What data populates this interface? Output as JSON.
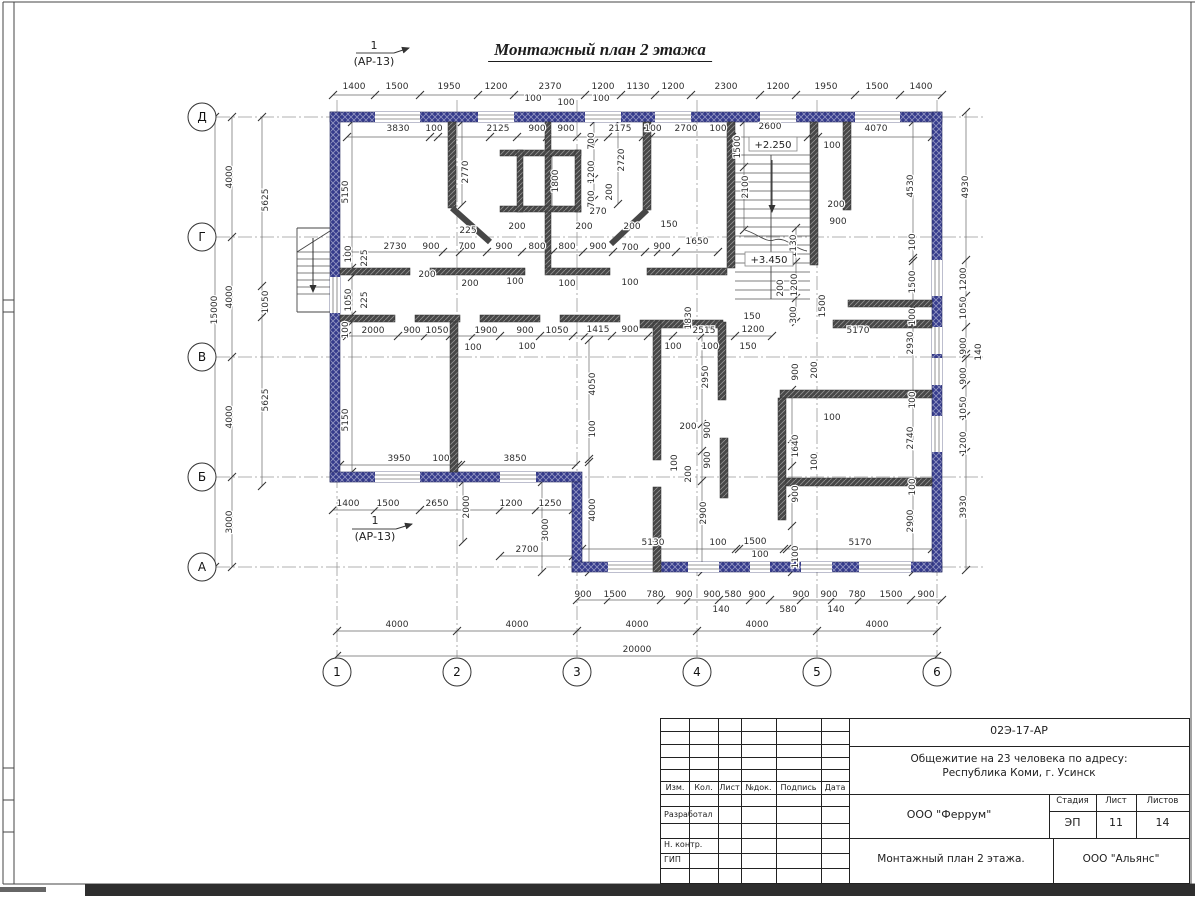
{
  "sheet": {
    "title": "Монтажный план 2 этажа"
  },
  "section_markers": [
    {
      "num": "1",
      "ref": "(АР-13)",
      "x": 374,
      "y": 49
    },
    {
      "num": "1",
      "ref": "(АР-13)",
      "x": 375,
      "y": 524
    }
  ],
  "levels": [
    {
      "t": "+2.250",
      "x": 773,
      "y": 147
    },
    {
      "t": "+3.450",
      "x": 769,
      "y": 262
    }
  ],
  "axes": {
    "rows": [
      [
        "Д",
        117
      ],
      [
        "Г",
        237
      ],
      [
        "В",
        357
      ],
      [
        "Б",
        477
      ],
      [
        "А",
        567
      ]
    ],
    "cols": [
      [
        "1",
        337
      ],
      [
        "2",
        457
      ],
      [
        "3",
        577
      ],
      [
        "4",
        697
      ],
      [
        "5",
        817
      ],
      [
        "6",
        937
      ]
    ]
  },
  "dims": [
    [
      354,
      89,
      "1400"
    ],
    [
      397,
      89,
      "1500"
    ],
    [
      449,
      89,
      "1950"
    ],
    [
      496,
      89,
      "1200"
    ],
    [
      550,
      89,
      "2370"
    ],
    [
      603,
      89,
      "1200"
    ],
    [
      638,
      89,
      "1130"
    ],
    [
      673,
      89,
      "1200"
    ],
    [
      726,
      89,
      "2300"
    ],
    [
      778,
      89,
      "1200"
    ],
    [
      826,
      89,
      "1950"
    ],
    [
      877,
      89,
      "1500"
    ],
    [
      921,
      89,
      "1400"
    ],
    [
      533,
      101,
      "100"
    ],
    [
      566,
      105,
      "100"
    ],
    [
      601,
      101,
      "100"
    ],
    [
      398,
      131,
      "3830"
    ],
    [
      434,
      131,
      "100"
    ],
    [
      498,
      131,
      "2125"
    ],
    [
      537,
      131,
      "900"
    ],
    [
      566,
      131,
      "900"
    ],
    [
      620,
      131,
      "2175"
    ],
    [
      653,
      131,
      "100"
    ],
    [
      686,
      131,
      "2700"
    ],
    [
      718,
      131,
      "100"
    ],
    [
      770,
      129,
      "2600"
    ],
    [
      876,
      131,
      "4070"
    ],
    [
      832,
      148,
      "100"
    ],
    [
      348,
      192,
      "5150",
      1
    ],
    [
      468,
      172,
      "2770",
      1
    ],
    [
      558,
      181,
      "1800",
      1
    ],
    [
      594,
      141,
      "700",
      1
    ],
    [
      594,
      172,
      "1200",
      1
    ],
    [
      594,
      199,
      "700",
      1
    ],
    [
      612,
      192,
      "200",
      1
    ],
    [
      624,
      160,
      "2720",
      1
    ],
    [
      740,
      147,
      "1500",
      1
    ],
    [
      748,
      187,
      "2100",
      1
    ],
    [
      913,
      186,
      "4530",
      1
    ],
    [
      968,
      187,
      "4930",
      1
    ],
    [
      796,
      246,
      "1130",
      1
    ],
    [
      797,
      285,
      "1200",
      1
    ],
    [
      783,
      288,
      "200",
      1
    ],
    [
      796,
      315,
      "300",
      1
    ],
    [
      825,
      306,
      "1500",
      1
    ],
    [
      836,
      207,
      "200"
    ],
    [
      838,
      224,
      "900"
    ],
    [
      395,
      249,
      "2730"
    ],
    [
      431,
      249,
      "900"
    ],
    [
      467,
      249,
      "700"
    ],
    [
      504,
      249,
      "900"
    ],
    [
      537,
      249,
      "800"
    ],
    [
      567,
      249,
      "800"
    ],
    [
      598,
      249,
      "900"
    ],
    [
      630,
      250,
      "700"
    ],
    [
      662,
      249,
      "900"
    ],
    [
      697,
      244,
      "1650"
    ],
    [
      669,
      227,
      "150"
    ],
    [
      468,
      233,
      "225"
    ],
    [
      517,
      229,
      "200"
    ],
    [
      584,
      229,
      "200"
    ],
    [
      632,
      229,
      "200"
    ],
    [
      427,
      277,
      "200"
    ],
    [
      470,
      286,
      "200"
    ],
    [
      515,
      284,
      "100"
    ],
    [
      567,
      286,
      "100"
    ],
    [
      630,
      285,
      "100"
    ],
    [
      598,
      214,
      "270"
    ],
    [
      351,
      254,
      "100",
      1
    ],
    [
      367,
      258,
      "225",
      1
    ],
    [
      351,
      300,
      "1050",
      1
    ],
    [
      367,
      300,
      "225",
      1
    ],
    [
      348,
      330,
      "100",
      1
    ],
    [
      373,
      333,
      "2000"
    ],
    [
      412,
      333,
      "900"
    ],
    [
      437,
      333,
      "1050"
    ],
    [
      486,
      333,
      "1900"
    ],
    [
      525,
      333,
      "900"
    ],
    [
      557,
      333,
      "1050"
    ],
    [
      598,
      332,
      "1415"
    ],
    [
      630,
      332,
      "900"
    ],
    [
      704,
      333,
      "2515"
    ],
    [
      753,
      332,
      "1200"
    ],
    [
      473,
      350,
      "100"
    ],
    [
      527,
      349,
      "100"
    ],
    [
      673,
      349,
      "100"
    ],
    [
      710,
      349,
      "100"
    ],
    [
      752,
      319,
      "150"
    ],
    [
      748,
      349,
      "150"
    ],
    [
      691,
      318,
      "1830",
      1
    ],
    [
      858,
      333,
      "5170"
    ],
    [
      913,
      343,
      "2930",
      1
    ],
    [
      595,
      384,
      "4050",
      1
    ],
    [
      595,
      429,
      "100",
      1
    ],
    [
      708,
      377,
      "2950",
      1
    ],
    [
      915,
      242,
      "100",
      1
    ],
    [
      915,
      282,
      "1500",
      1
    ],
    [
      915,
      317,
      "100",
      1
    ],
    [
      915,
      400,
      "100",
      1
    ],
    [
      913,
      438,
      "2740",
      1
    ],
    [
      915,
      487,
      "100",
      1
    ],
    [
      913,
      521,
      "2900",
      1
    ],
    [
      966,
      279,
      "1200",
      1
    ],
    [
      966,
      308,
      "1050",
      1
    ],
    [
      966,
      346,
      "900",
      1
    ],
    [
      981,
      352,
      "140",
      1
    ],
    [
      966,
      376,
      "900",
      1
    ],
    [
      966,
      408,
      "1050",
      1
    ],
    [
      966,
      443,
      "1200",
      1
    ],
    [
      966,
      507,
      "3930",
      1
    ],
    [
      688,
      429,
      "200"
    ],
    [
      710,
      430,
      "900",
      1
    ],
    [
      677,
      463,
      "100",
      1
    ],
    [
      691,
      474,
      "200",
      1
    ],
    [
      710,
      460,
      "900",
      1
    ],
    [
      595,
      510,
      "4000",
      1
    ],
    [
      706,
      513,
      "2900",
      1
    ],
    [
      798,
      446,
      "1640",
      1
    ],
    [
      817,
      462,
      "100",
      1
    ],
    [
      798,
      494,
      "900",
      1
    ],
    [
      798,
      557,
      "1100",
      1
    ],
    [
      798,
      372,
      "900",
      1
    ],
    [
      817,
      370,
      "200",
      1
    ],
    [
      832,
      420,
      "100"
    ],
    [
      399,
      461,
      "3950"
    ],
    [
      441,
      461,
      "100"
    ],
    [
      515,
      461,
      "3850"
    ],
    [
      348,
      420,
      "5150",
      1
    ],
    [
      348,
      506,
      "1400"
    ],
    [
      388,
      506,
      "1500"
    ],
    [
      437,
      506,
      "2650"
    ],
    [
      469,
      507,
      "2000",
      1
    ],
    [
      511,
      506,
      "1200"
    ],
    [
      550,
      506,
      "1250"
    ],
    [
      548,
      530,
      "3000",
      1
    ],
    [
      527,
      552,
      "2700"
    ],
    [
      653,
      545,
      "5130"
    ],
    [
      718,
      545,
      "100"
    ],
    [
      755,
      544,
      "1500"
    ],
    [
      760,
      557,
      "100"
    ],
    [
      860,
      545,
      "5170"
    ],
    [
      583,
      597,
      "900"
    ],
    [
      615,
      597,
      "1500"
    ],
    [
      655,
      597,
      "780"
    ],
    [
      684,
      597,
      "900"
    ],
    [
      712,
      597,
      "900"
    ],
    [
      733,
      597,
      "580"
    ],
    [
      757,
      597,
      "900"
    ],
    [
      801,
      597,
      "900"
    ],
    [
      829,
      597,
      "900"
    ],
    [
      857,
      597,
      "780"
    ],
    [
      891,
      597,
      "1500"
    ],
    [
      926,
      597,
      "900"
    ],
    [
      721,
      612,
      "140"
    ],
    [
      788,
      612,
      "580"
    ],
    [
      836,
      612,
      "140"
    ],
    [
      397,
      627,
      "4000"
    ],
    [
      517,
      627,
      "4000"
    ],
    [
      637,
      627,
      "4000"
    ],
    [
      757,
      627,
      "4000"
    ],
    [
      877,
      627,
      "4000"
    ],
    [
      637,
      652,
      "20000"
    ],
    [
      232,
      177,
      "4000",
      1
    ],
    [
      232,
      297,
      "4000",
      1
    ],
    [
      232,
      417,
      "4000",
      1
    ],
    [
      232,
      522,
      "3000",
      1
    ],
    [
      217,
      310,
      "15000",
      1
    ],
    [
      268,
      200,
      "5625",
      1
    ],
    [
      268,
      302,
      "1050",
      1
    ],
    [
      268,
      400,
      "5625",
      1
    ]
  ],
  "geometry": {
    "walls_ext": [
      [
        330,
        112,
        612,
        10
      ],
      [
        330,
        112,
        10,
        370
      ],
      [
        330,
        472,
        252,
        10
      ],
      [
        572,
        482,
        10,
        90
      ],
      [
        572,
        562,
        370,
        10
      ],
      [
        932,
        112,
        10,
        460
      ]
    ],
    "windows_h": [
      [
        112,
        375,
        420
      ],
      [
        112,
        478,
        514
      ],
      [
        112,
        585,
        621
      ],
      [
        112,
        655,
        691
      ],
      [
        112,
        760,
        796
      ],
      [
        112,
        855,
        900
      ],
      [
        472,
        375,
        420
      ],
      [
        472,
        500,
        536
      ],
      [
        562,
        608,
        661
      ],
      [
        562,
        688,
        719
      ],
      [
        562,
        750,
        770
      ],
      [
        562,
        801,
        832
      ],
      [
        562,
        859,
        911
      ]
    ],
    "windows_v": [
      [
        932,
        260,
        296
      ],
      [
        932,
        327,
        354
      ],
      [
        932,
        358,
        385
      ],
      [
        932,
        416,
        452
      ],
      [
        330,
        277,
        313
      ]
    ],
    "walls_int": [
      [
        448,
        122,
        8,
        86
      ],
      [
        545,
        122,
        6,
        146
      ],
      [
        500,
        150,
        81,
        6
      ],
      [
        500,
        206,
        81,
        6
      ],
      [
        517,
        150,
        6,
        62
      ],
      [
        575,
        150,
        6,
        62
      ],
      [
        643,
        122,
        8,
        88
      ],
      [
        727,
        122,
        8,
        146
      ],
      [
        810,
        122,
        8,
        143
      ],
      [
        843,
        122,
        8,
        88
      ],
      [
        340,
        268,
        70,
        7
      ],
      [
        430,
        268,
        95,
        7
      ],
      [
        545,
        268,
        65,
        7
      ],
      [
        647,
        268,
        80,
        7
      ],
      [
        340,
        315,
        55,
        7
      ],
      [
        415,
        315,
        45,
        7
      ],
      [
        480,
        315,
        60,
        7
      ],
      [
        560,
        315,
        60,
        7
      ],
      [
        640,
        320,
        83,
        8
      ],
      [
        833,
        320,
        99,
        8
      ],
      [
        450,
        322,
        8,
        150
      ],
      [
        848,
        300,
        84,
        7
      ],
      [
        653,
        322,
        8,
        138
      ],
      [
        653,
        487,
        8,
        85
      ],
      [
        718,
        322,
        8,
        78
      ],
      [
        720,
        438,
        8,
        60
      ],
      [
        780,
        390,
        152,
        8
      ],
      [
        780,
        478,
        152,
        8
      ],
      [
        778,
        398,
        8,
        122
      ]
    ],
    "diagonals": [
      [
        452,
        208,
        490,
        242
      ],
      [
        647,
        210,
        611,
        244
      ]
    ],
    "dimlines_h": [
      [
        95,
        [
          333,
          375,
          420,
          478,
          514,
          585,
          621,
          655,
          691,
          760,
          796,
          855,
          900,
          942
        ]
      ],
      [
        137,
        [
          347,
          430,
          438,
          490,
          517,
          547,
          577,
          608,
          643,
          651,
          732,
          808,
          818,
          932
        ]
      ],
      [
        252,
        [
          347,
          443,
          460,
          487,
          522,
          553,
          583,
          613,
          645,
          658,
          676,
          718
        ]
      ],
      [
        336,
        [
          347,
          398,
          425,
          450,
          473,
          500,
          540,
          573,
          585,
          612,
          648,
          673,
          735,
          772
        ]
      ],
      [
        465,
        [
          340,
          458,
          461,
          576
        ]
      ],
      [
        549,
        [
          582,
          736,
          739,
          784,
          787,
          932
        ]
      ],
      [
        600,
        [
          577,
          608,
          661,
          688,
          719,
          750,
          770,
          801,
          832,
          859,
          911,
          942
        ]
      ],
      [
        631,
        [
          337,
          457,
          577,
          697,
          817,
          937
        ]
      ],
      [
        656,
        [
          337,
          937
        ]
      ],
      [
        510,
        [
          333,
          375,
          420,
          500,
          536,
          573
        ]
      ],
      [
        556,
        [
          500,
          573
        ]
      ]
    ],
    "dimlines_v": [
      [
        232,
        [
          117,
          237,
          357,
          477,
          567
        ]
      ],
      [
        262,
        [
          117,
          286,
          317,
          486
        ]
      ],
      [
        215,
        [
          117,
          567
        ]
      ],
      [
        352,
        [
          122,
          268,
          277,
          315,
          322,
          472
        ]
      ],
      [
        594,
        [
          122,
          143,
          179,
          200
        ]
      ],
      [
        462,
        [
          122,
          205
        ]
      ],
      [
        552,
        [
          156,
          210
        ]
      ],
      [
        618,
        [
          122,
          204
        ]
      ],
      [
        744,
        [
          122,
          167,
          230
        ]
      ],
      [
        796,
        [
          228,
          262,
          298,
          322
        ]
      ],
      [
        913,
        [
          122,
          258,
          261,
          306,
          309,
          397,
          400,
          482,
          485,
          572
        ]
      ],
      [
        966,
        [
          112,
          260,
          296,
          327,
          354,
          358,
          385,
          416,
          452,
          570
        ]
      ],
      [
        589,
        [
          340,
          459,
          462,
          572
        ]
      ],
      [
        702,
        [
          336,
          424,
          451,
          481,
          572
        ]
      ],
      [
        792,
        [
          390,
          439,
          466,
          493,
          526,
          572
        ]
      ],
      [
        463,
        [
          482,
          542
        ]
      ],
      [
        542,
        [
          482,
          572
        ]
      ]
    ],
    "steps": [
      [
        735,
        810,
        155,
        299,
        17
      ],
      [
        297,
        330,
        252,
        294,
        7
      ]
    ],
    "lines": [
      [
        771,
        155,
        771,
        299
      ],
      [
        297,
        228,
        330,
        228
      ],
      [
        297,
        228,
        297,
        312
      ],
      [
        297,
        312,
        330,
        312
      ],
      [
        297,
        252,
        330,
        231
      ],
      [
        356,
        53,
        394,
        53
      ],
      [
        352,
        529,
        396,
        529
      ],
      [
        3,
        2,
        1195,
        2
      ],
      [
        3,
        2,
        3,
        884
      ],
      [
        14,
        2,
        14,
        884
      ],
      [
        1191,
        2,
        1191,
        884
      ],
      [
        3,
        884,
        1195,
        884
      ],
      [
        3,
        300,
        14,
        300
      ],
      [
        3,
        312,
        14,
        312
      ],
      [
        3,
        768,
        14,
        768
      ],
      [
        3,
        800,
        14,
        800
      ],
      [
        3,
        832,
        14,
        832
      ]
    ],
    "arrows": [
      [
        772,
        160,
        772,
        212
      ],
      [
        313,
        238,
        313,
        292
      ],
      [
        394,
        53,
        409,
        48
      ],
      [
        396,
        529,
        412,
        524
      ]
    ],
    "curves": [
      "M745,230 C758,234 766,243 774,240 C786,236 794,249 807,251"
    ],
    "bands": [
      [
        85,
        884,
        1110,
        12,
        "#2e2e2e"
      ],
      [
        0,
        887,
        46,
        5,
        "#666666"
      ]
    ]
  },
  "colors": {
    "wall_ext": "#353b8c",
    "wall_int": "#474747",
    "dim_line": "#666666",
    "dim_text": "#2e2e2e",
    "axis_line": "#999999"
  },
  "title_block": {
    "doc_number": "02Э-17-АР",
    "object_line1": "Общежитие на 23 человека по адресу:",
    "object_line2": "Республика Коми, г. Усинск",
    "col_izm": "Изм.",
    "col_kol": "Кол.",
    "col_list": "Лист",
    "col_doc": "№док.",
    "col_sign": "Подпись",
    "col_date": "Дата",
    "row_dev": "Разработал",
    "row_ncontr": "Н. контр.",
    "row_gip": "ГИП",
    "org": "ООО \"Феррум\"",
    "stage_label": "Стадия",
    "sheet_label": "Лист",
    "sheets_label": "Листов",
    "stage": "ЭП",
    "sheet_no": "11",
    "sheets_total": "14",
    "doc_title": "Монтажный план 2 этажа.",
    "org2": "ООО \"Альянс\""
  }
}
